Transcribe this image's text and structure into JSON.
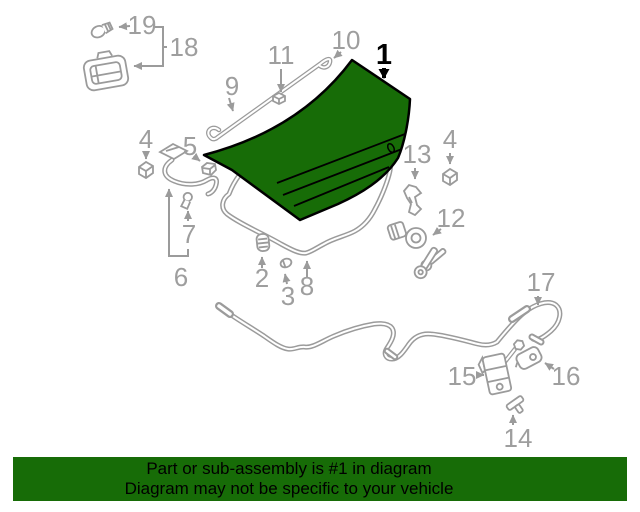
{
  "diagram": {
    "highlighted_callout": "1",
    "colors": {
      "highlight_green": "#176c07",
      "line_gray": "#9b9b9b",
      "label_gray": "#9e9e9e",
      "outline_black": "#000000",
      "background": "#ffffff"
    },
    "callouts": [
      {
        "number": "1"
      },
      {
        "number": "2"
      },
      {
        "number": "3"
      },
      {
        "number": "4"
      },
      {
        "number": "4"
      },
      {
        "number": "5"
      },
      {
        "number": "6"
      },
      {
        "number": "7"
      },
      {
        "number": "8"
      },
      {
        "number": "9"
      },
      {
        "number": "10"
      },
      {
        "number": "11"
      },
      {
        "number": "12"
      },
      {
        "number": "13"
      },
      {
        "number": "14"
      },
      {
        "number": "15"
      },
      {
        "number": "16"
      },
      {
        "number": "17"
      },
      {
        "number": "18"
      },
      {
        "number": "19"
      }
    ]
  },
  "banner": {
    "line1": "Part or sub-assembly is #1 in diagram",
    "line2": "Diagram may not be specific to your vehicle",
    "background": "#176c07",
    "text_color": "#000000"
  }
}
